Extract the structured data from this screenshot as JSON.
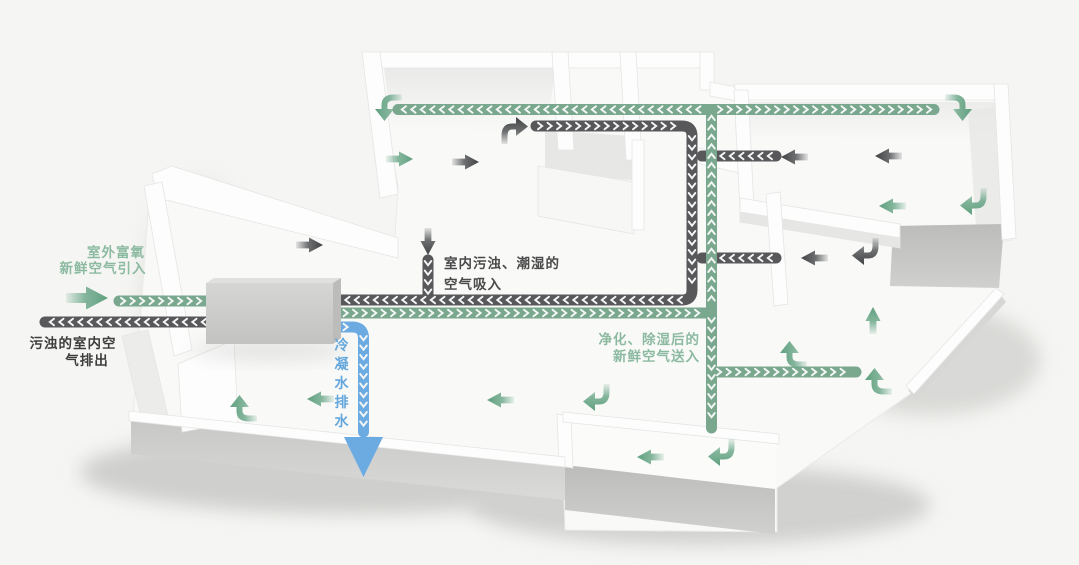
{
  "diagram": {
    "labels": {
      "fresh_intake": {
        "line1": "室外富氧",
        "line2": "新鲜空气引入"
      },
      "exhaust_out": {
        "line1": "污浊的室内空",
        "line2": "气排出"
      },
      "indoor_intake": {
        "line1": "室内污浊、潮湿的",
        "line2": "空气吸入"
      },
      "condensate": {
        "text": "冷凝水排水"
      },
      "supply": {
        "line1": "净化、除湿后的",
        "line2": "新鲜空气送入"
      }
    },
    "colors": {
      "fresh_air_line": "#7aa88e",
      "fresh_air_arrow": "#5fa07f",
      "fresh_air_text": "#8cbaa0",
      "exhaust_line": "#58585a",
      "exhaust_arrow": "#404244",
      "exhaust_text": "#3d3d3d",
      "indoor_intake_text": "#4a4a4a",
      "condensate_line": "#6cabe2",
      "condensate_text": "#63a7dc",
      "chevron": "#f4f7f5"
    }
  }
}
